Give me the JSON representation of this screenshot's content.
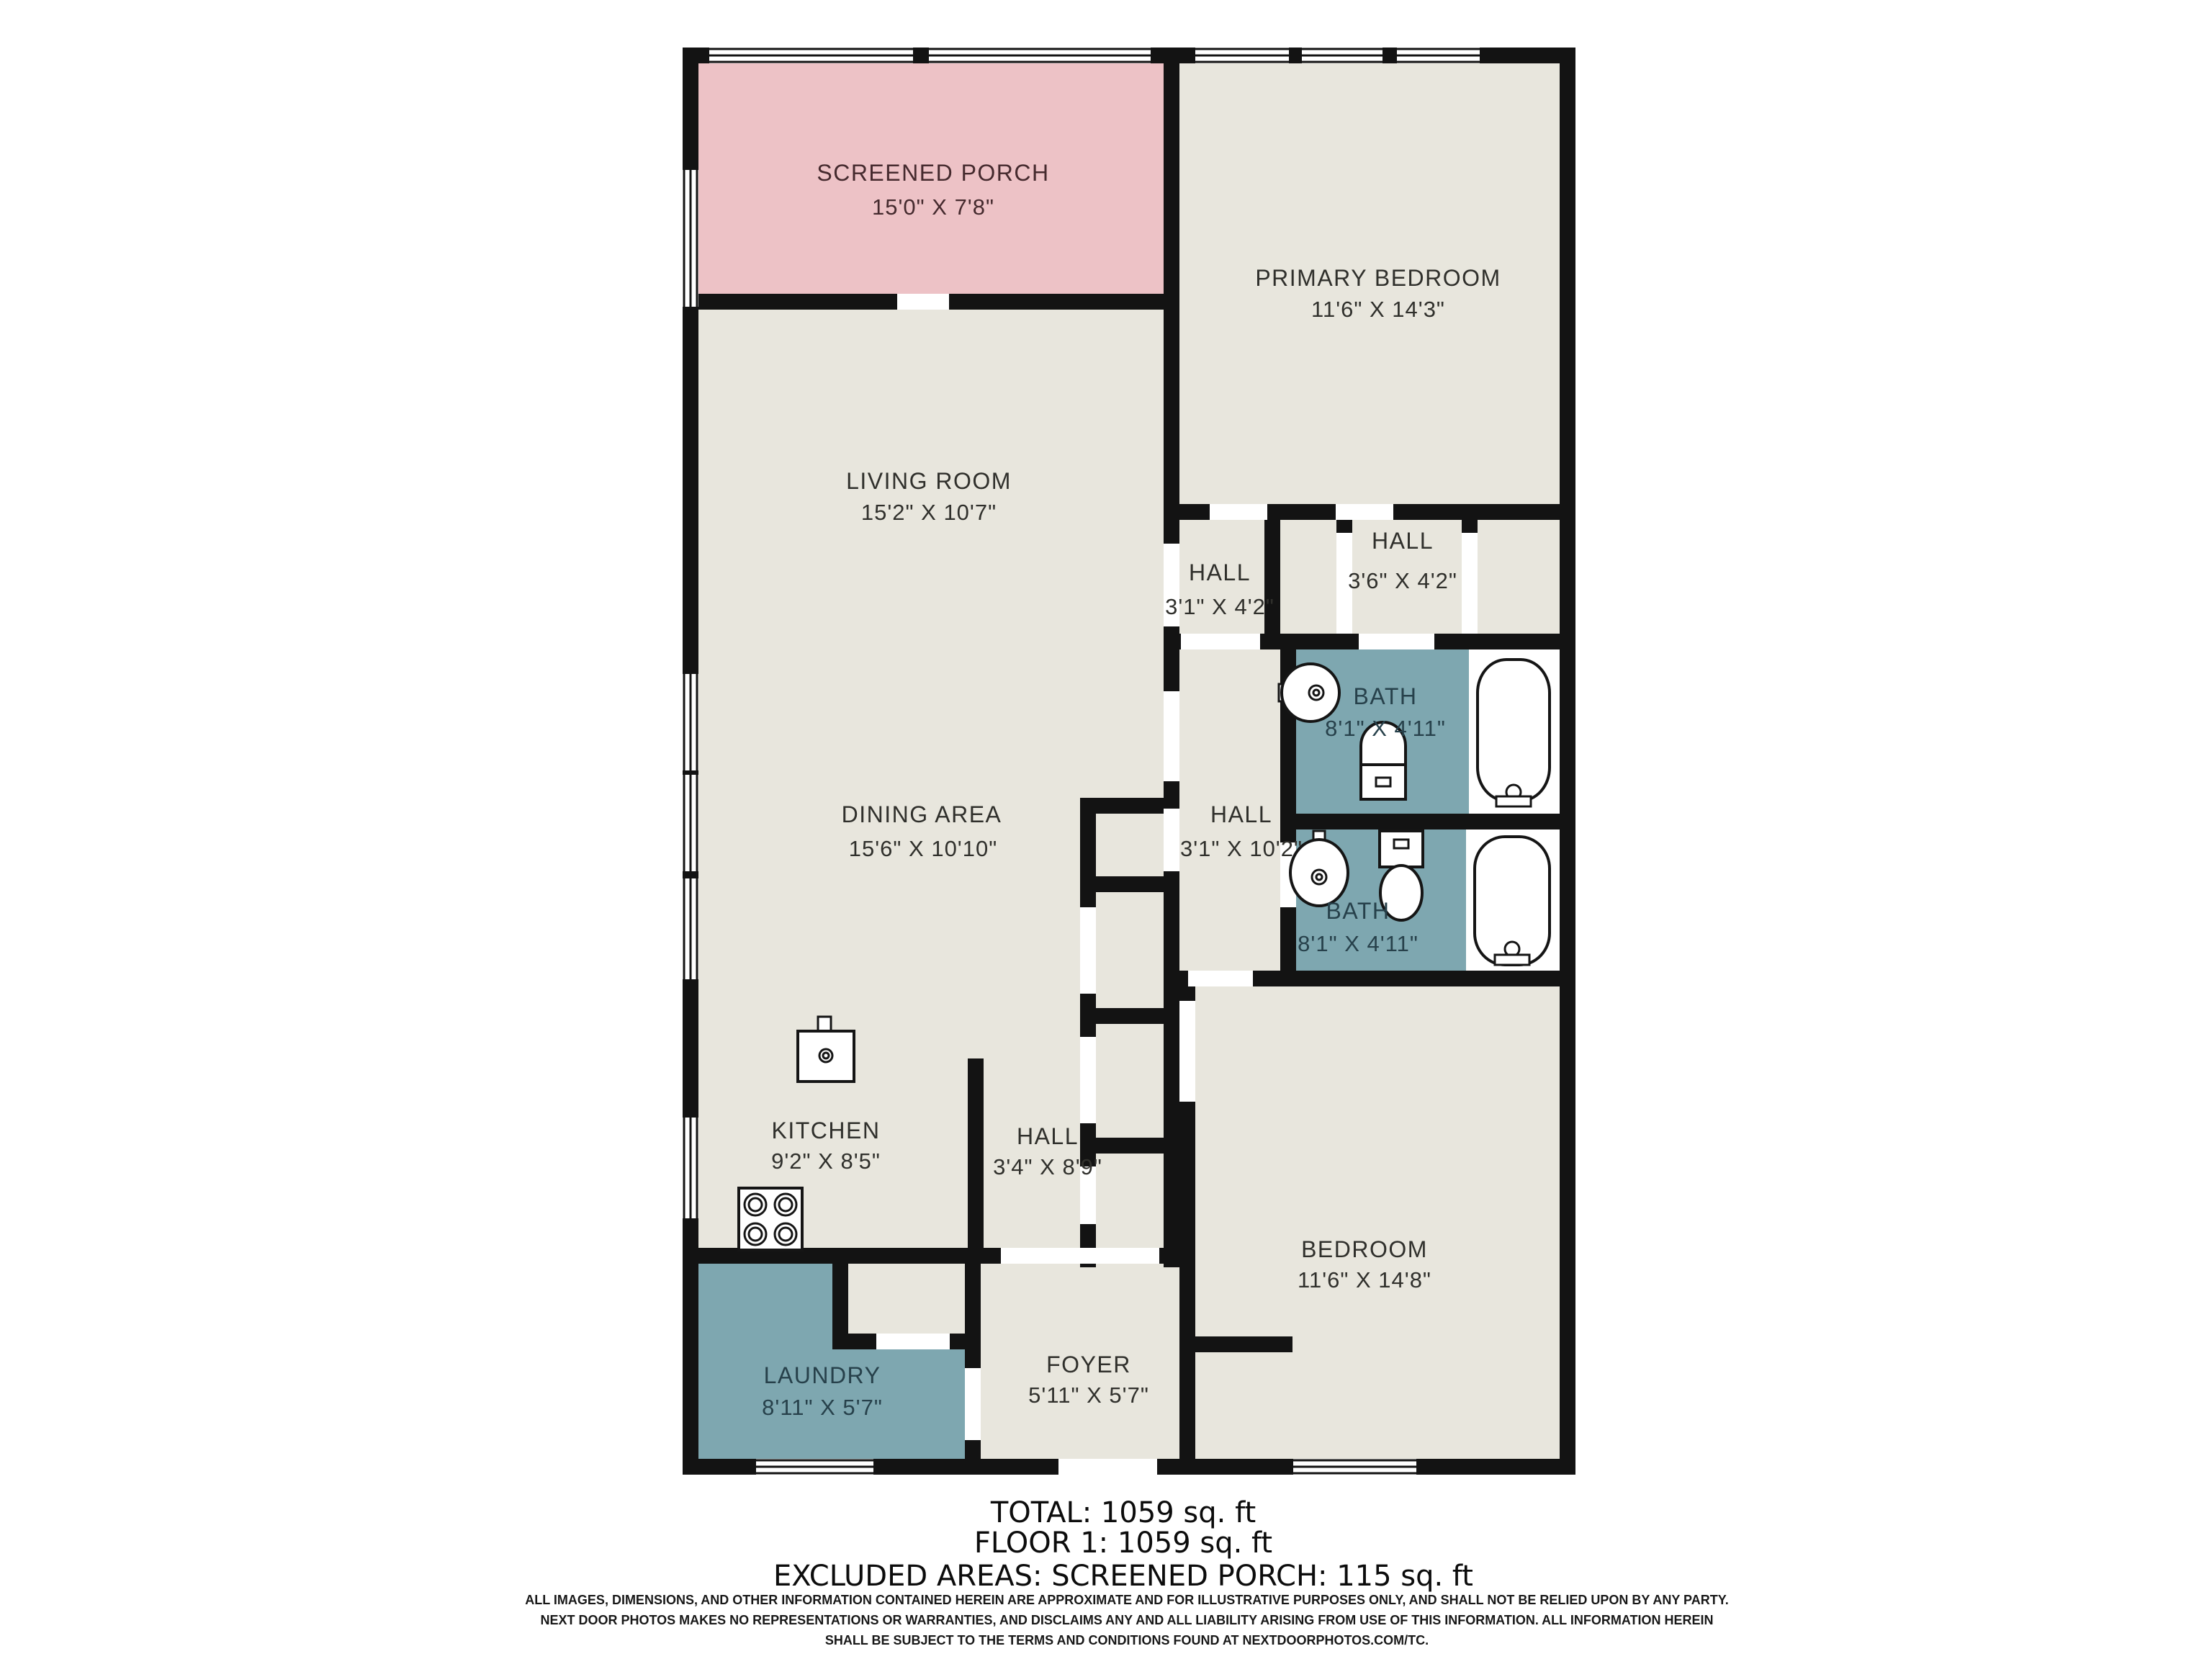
{
  "colors": {
    "wall": "#131313",
    "floor": "#e8e6dd",
    "porch": "#edc2c6",
    "wet": "#7ea7b0",
    "label": "#30302c",
    "porch_label": "#452a2e",
    "wet_label": "#27414b"
  },
  "rooms": [
    {
      "id": "screened-porch",
      "name": "SCREENED PORCH",
      "dims": "15'0\" X 7'8\""
    },
    {
      "id": "primary-bedroom",
      "name": "PRIMARY BEDROOM",
      "dims": "11'6\" X 14'3\""
    },
    {
      "id": "living-room",
      "name": "LIVING ROOM",
      "dims": "15'2\" X 10'7\""
    },
    {
      "id": "hall-upper-left",
      "name": "HALL",
      "dims": "3'1\" X 4'2\""
    },
    {
      "id": "hall-upper-right",
      "name": "HALL",
      "dims": "3'6\" X 4'2\""
    },
    {
      "id": "bath-primary",
      "name": "BATH",
      "dims": "8'1\" X 4'11\""
    },
    {
      "id": "hall-middle",
      "name": "HALL",
      "dims": "3'1\" X 10'2\""
    },
    {
      "id": "bath-second",
      "name": "BATH",
      "dims": "8'1\" X 4'11\""
    },
    {
      "id": "dining-area",
      "name": "DINING AREA",
      "dims": "15'6\" X 10'10\""
    },
    {
      "id": "kitchen",
      "name": "KITCHEN",
      "dims": "9'2\" X 8'5\""
    },
    {
      "id": "hall-lower",
      "name": "HALL",
      "dims": "3'4\" X 8'9\""
    },
    {
      "id": "bedroom",
      "name": "BEDROOM",
      "dims": "11'6\" X 14'8\""
    },
    {
      "id": "laundry",
      "name": "LAUNDRY",
      "dims": "8'11\" X 5'7\""
    },
    {
      "id": "foyer",
      "name": "FOYER",
      "dims": "5'11\" X 5'7\""
    }
  ],
  "summary": {
    "total": "TOTAL: 1059 sq. ft",
    "floor1": "FLOOR 1: 1059 sq. ft",
    "excluded": "EXCLUDED AREAS: SCREENED PORCH: 115 sq. ft"
  },
  "disclaimer": {
    "line1": "ALL IMAGES, DIMENSIONS, AND OTHER INFORMATION CONTAINED HEREIN ARE APPROXIMATE AND FOR ILLUSTRATIVE PURPOSES ONLY, AND SHALL NOT BE RELIED UPON BY ANY PARTY.",
    "line2": "NEXT DOOR PHOTOS MAKES NO REPRESENTATIONS OR WARRANTIES, AND DISCLAIMS ANY AND ALL LIABILITY ARISING FROM USE OF THIS INFORMATION. ALL INFORMATION HEREIN",
    "line3": "SHALL BE SUBJECT TO THE TERMS AND CONDITIONS FOUND AT NEXTDOORPHOTOS.COM/TC."
  },
  "fixtures": [
    "sink-icon",
    "toilet-icon",
    "bathtub-icon",
    "sink-icon",
    "toilet-icon",
    "bathtub-icon",
    "kitchen-sink-icon",
    "stove-icon"
  ]
}
